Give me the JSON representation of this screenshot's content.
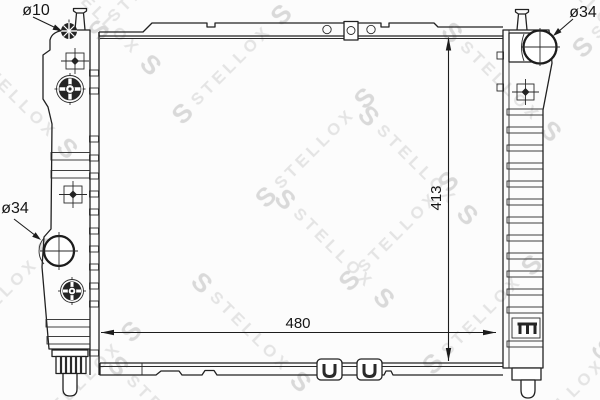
{
  "diagram": {
    "kind": "radiator-technical-drawing",
    "background": "#fcfcfc",
    "line_color": "#212121",
    "watermark": {
      "initial": "S",
      "brand": "STELLOX",
      "text_color": "#e4e4e4",
      "logo_color": "#d9d9d9"
    },
    "labels": {
      "port_top_left_diameter": "ø10",
      "port_top_right_diameter": "ø34",
      "port_left_diameter": "ø34"
    },
    "dimensions": {
      "core_width": "480",
      "core_height": "413"
    }
  }
}
